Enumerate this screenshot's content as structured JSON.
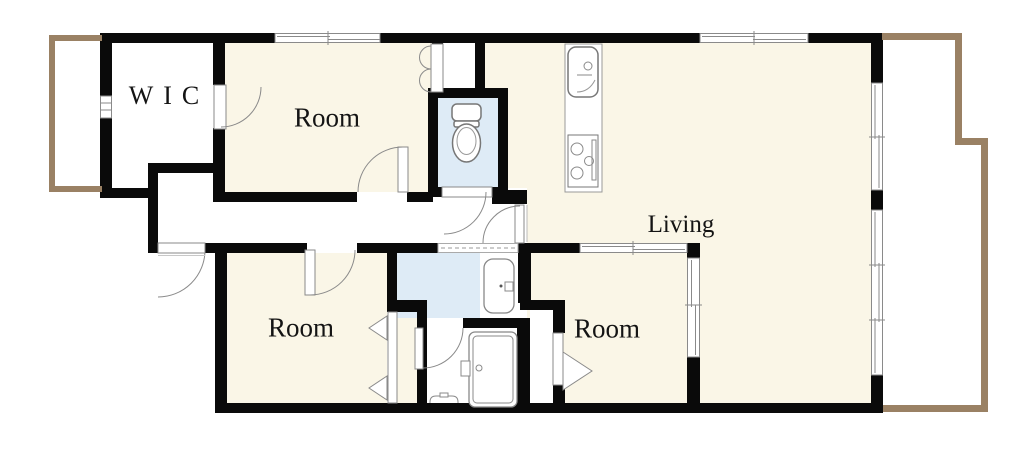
{
  "floorplan": {
    "title": "apartment-floorplan",
    "rooms": [
      {
        "id": "wic",
        "label": "WIC"
      },
      {
        "id": "room-top",
        "label": "Room"
      },
      {
        "id": "living",
        "label": "Living"
      },
      {
        "id": "room-bottom-left",
        "label": "Room"
      },
      {
        "id": "room-bottom-middle",
        "label": "Room"
      }
    ],
    "fixtures": [
      {
        "id": "toilet",
        "name": "toilet"
      },
      {
        "id": "kitchen-sink",
        "name": "kitchen sink"
      },
      {
        "id": "stove",
        "name": "stove"
      },
      {
        "id": "washbasin",
        "name": "washbasin vanity"
      },
      {
        "id": "bathtub",
        "name": "bathtub"
      }
    ],
    "colors": {
      "room_floor": "#faf6e7",
      "wet_area_floor": "#deebf6",
      "balcony_outline": "#9a8164",
      "wall": "#0a0a0a",
      "fixture_stroke": "#8a8a8a"
    }
  }
}
